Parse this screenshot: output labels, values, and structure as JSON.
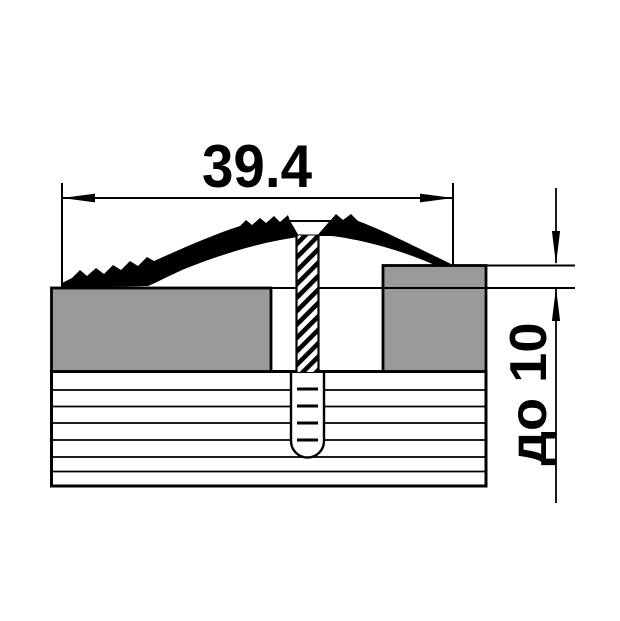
{
  "diagram": {
    "type": "threshold-profile-cross-section",
    "labels": {
      "width_dimension": "39.4",
      "height_dimension": "до 10"
    },
    "colors": {
      "outline": "#000000",
      "floor_fill": "#9a9a9a",
      "background": "#ffffff"
    }
  }
}
